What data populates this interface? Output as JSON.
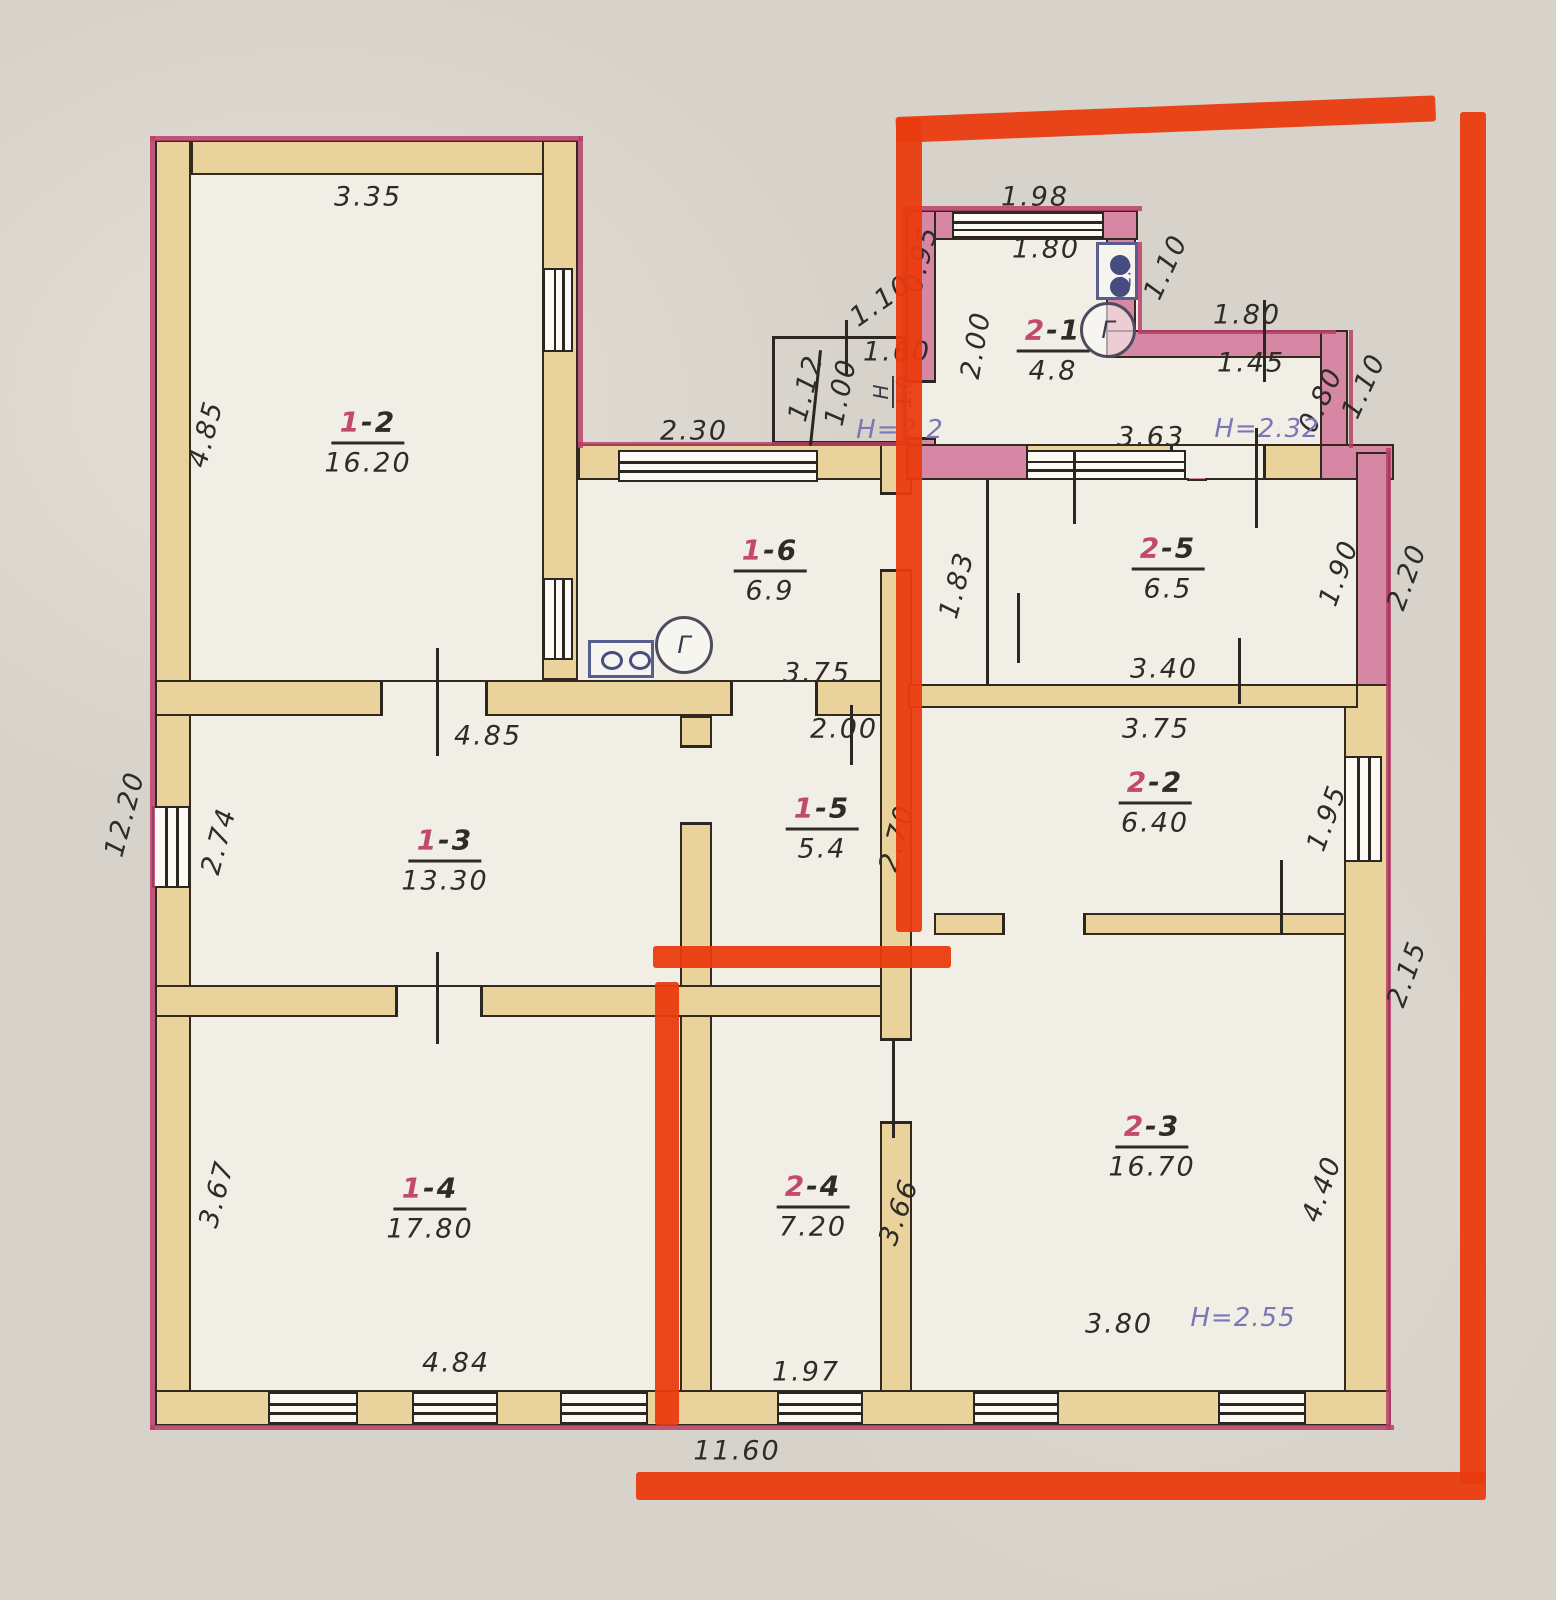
{
  "palette": {
    "paper": "#d7d3cb",
    "room": "#f1eee6",
    "wall_tan": "#e9d29c",
    "wall_pink": "#d687a3",
    "outline": "#33291f",
    "crimson": "#b8406a",
    "marker_orange": "#ea3a0e",
    "ink": "#2f2b26",
    "red_digit": "#c14a6e",
    "height_purple": "#7b76b6",
    "icon_blue": "#585e90"
  },
  "rooms": [
    {
      "prefix": "1",
      "suffix": "-2",
      "area": "16.20",
      "x": 368,
      "y": 442
    },
    {
      "prefix": "1",
      "suffix": "-6",
      "area": "6.9",
      "x": 770,
      "y": 570
    },
    {
      "prefix": "2",
      "suffix": "-1",
      "area": "4.8",
      "x": 1053,
      "y": 350
    },
    {
      "prefix": "2",
      "suffix": "-5",
      "area": "6.5",
      "x": 1168,
      "y": 568
    },
    {
      "prefix": "2",
      "suffix": "-2",
      "area": "6.40",
      "x": 1155,
      "y": 802
    },
    {
      "prefix": "1",
      "suffix": "-5",
      "area": "5.4",
      "x": 822,
      "y": 828
    },
    {
      "prefix": "1",
      "suffix": "-3",
      "area": "13.30",
      "x": 445,
      "y": 860
    },
    {
      "prefix": "2",
      "suffix": "-3",
      "area": "16.70",
      "x": 1152,
      "y": 1146
    },
    {
      "prefix": "1",
      "suffix": "-4",
      "area": "17.80",
      "x": 430,
      "y": 1208
    },
    {
      "prefix": "2",
      "suffix": "-4",
      "area": "7.20",
      "x": 813,
      "y": 1206
    }
  ],
  "dims": [
    [
      "3.35",
      368,
      197,
      0
    ],
    [
      "4.85",
      206,
      434,
      -75
    ],
    [
      "2.30",
      694,
      431,
      0
    ],
    [
      "1.12",
      806,
      388,
      -75
    ],
    [
      "1.00",
      841,
      392,
      -78
    ],
    [
      "1.10",
      881,
      301,
      -35
    ],
    [
      "1.60",
      897,
      352,
      0
    ],
    [
      "1.98",
      1035,
      197,
      0
    ],
    [
      "1.80",
      1046,
      249,
      0
    ],
    [
      "0.95",
      921,
      259,
      -75
    ],
    [
      "2.00",
      976,
      345,
      -80
    ],
    [
      "1.10",
      1166,
      267,
      -65
    ],
    [
      "1.80",
      1247,
      315,
      0
    ],
    [
      "1.45",
      1251,
      363,
      0
    ],
    [
      "0.80",
      1321,
      400,
      -65
    ],
    [
      "1.10",
      1364,
      386,
      -65
    ],
    [
      "3.63",
      1151,
      437,
      0
    ],
    [
      "1.83",
      957,
      585,
      -75
    ],
    [
      "1.90",
      1339,
      573,
      -70
    ],
    [
      "2.20",
      1407,
      577,
      -70
    ],
    [
      "3.40",
      1164,
      669,
      0
    ],
    [
      "3.75",
      1156,
      729,
      0
    ],
    [
      "1.95",
      1327,
      818,
      -70
    ],
    [
      "4.40",
      1322,
      1189,
      -70
    ],
    [
      "2.15",
      1407,
      974,
      -70
    ],
    [
      "3.80",
      1119,
      1324,
      0
    ],
    [
      "3.66",
      899,
      1212,
      -70
    ],
    [
      "1.97",
      806,
      1372,
      0
    ],
    [
      "11.60",
      737,
      1451,
      0
    ],
    [
      "2.00",
      844,
      729,
      0
    ],
    [
      "2.70",
      897,
      838,
      -75
    ],
    [
      "3.75",
      817,
      673,
      0
    ],
    [
      "4.85",
      488,
      736,
      0
    ],
    [
      "2.74",
      219,
      841,
      -75
    ],
    [
      "12.20",
      125,
      814,
      -75
    ],
    [
      "3.67",
      217,
      1194,
      -75
    ],
    [
      "4.84",
      456,
      1363,
      0
    ]
  ],
  "heights": [
    [
      "Н=2.2",
      900,
      430
    ],
    [
      "Н=2.32",
      1267,
      429
    ],
    [
      "Н=2.55",
      1243,
      1318
    ]
  ],
  "fraction": {
    "top": "Н",
    "bottom": "1.0",
    "x": 893,
    "y": 392,
    "rot": -90
  },
  "gas_meters": [
    {
      "label": "Г",
      "x": 1108,
      "y": 330,
      "r": 28
    },
    {
      "label": "Г",
      "x": 684,
      "y": 645,
      "r": 29
    }
  ],
  "stoves": [
    {
      "x": 1096,
      "y": 242,
      "w": 42,
      "h": 58,
      "layout": "stack",
      "text": "2.8"
    },
    {
      "x": 588,
      "y": 640,
      "w": 66,
      "h": 38,
      "layout": "row",
      "text": ""
    }
  ],
  "geometry": {
    "footprints": [
      [
        155,
        141,
        423,
        1284
      ],
      [
        578,
        444,
        812,
        981
      ],
      [
        906,
        212,
        232,
        232
      ],
      [
        1108,
        332,
        240,
        112
      ]
    ],
    "walls": [
      [
        155,
        140,
        36,
        1285
      ],
      [
        191,
        140,
        387,
        35
      ],
      [
        542,
        140,
        36,
        540
      ],
      [
        578,
        444,
        330,
        36
      ],
      [
        906,
        444,
        455,
        36
      ],
      [
        155,
        680,
        753,
        36
      ],
      [
        680,
        716,
        32,
        676
      ],
      [
        155,
        985,
        753,
        32
      ],
      [
        880,
        444,
        32,
        948
      ],
      [
        155,
        1390,
        1236,
        36
      ],
      [
        1344,
        684,
        46,
        708
      ],
      [
        908,
        684,
        450,
        24
      ],
      [
        934,
        913,
        412,
        22
      ]
    ],
    "pink_walls": [
      [
        906,
        210,
        232,
        30
      ],
      [
        906,
        210,
        30,
        236
      ],
      [
        1106,
        238,
        30,
        108
      ],
      [
        1106,
        330,
        222,
        28
      ],
      [
        1320,
        330,
        28,
        116
      ],
      [
        906,
        444,
        122,
        36
      ],
      [
        1320,
        444,
        74,
        36
      ],
      [
        1356,
        452,
        34,
        234
      ],
      [
        1187,
        455,
        20,
        26
      ]
    ],
    "thin_lines": [
      [
        986,
        480,
        3,
        206
      ]
    ],
    "porch": [
      772,
      336,
      134,
      108
    ],
    "windows": [
      [
        543,
        268,
        30,
        84,
        "v"
      ],
      [
        543,
        578,
        30,
        82,
        "v"
      ],
      [
        152,
        806,
        38,
        82,
        "v"
      ],
      [
        1344,
        756,
        38,
        106,
        "v"
      ],
      [
        618,
        450,
        200,
        32,
        "h"
      ],
      [
        952,
        212,
        152,
        26,
        "h"
      ],
      [
        1026,
        450,
        160,
        30,
        "h"
      ],
      [
        268,
        1392,
        90,
        32,
        "h"
      ],
      [
        412,
        1392,
        86,
        32,
        "h"
      ],
      [
        560,
        1392,
        88,
        32,
        "h"
      ],
      [
        777,
        1392,
        86,
        32,
        "h"
      ],
      [
        973,
        1392,
        86,
        32,
        "h"
      ],
      [
        1218,
        1392,
        88,
        32,
        "h"
      ]
    ],
    "door_gaps": [
      [
        380,
        682,
        108,
        34,
        "h"
      ],
      [
        730,
        682,
        88,
        34,
        "h"
      ],
      [
        395,
        987,
        88,
        30,
        "h"
      ],
      [
        1002,
        913,
        84,
        22,
        "h"
      ],
      [
        1170,
        446,
        96,
        32,
        "h"
      ],
      [
        680,
        745,
        32,
        80,
        "v"
      ],
      [
        880,
        492,
        32,
        80,
        "v"
      ],
      [
        906,
        380,
        30,
        60,
        "v"
      ],
      [
        880,
        1038,
        32,
        86,
        "v"
      ]
    ],
    "ticks": [
      [
        436,
        648,
        3,
        108,
        0
      ],
      [
        436,
        952,
        3,
        92,
        0
      ],
      [
        1017,
        593,
        3,
        70,
        0
      ],
      [
        1238,
        638,
        3,
        66,
        0
      ],
      [
        1073,
        452,
        3,
        72,
        0
      ],
      [
        1263,
        300,
        3,
        82,
        0
      ],
      [
        1255,
        428,
        3,
        100,
        0
      ],
      [
        892,
        1038,
        3,
        100,
        0
      ],
      [
        850,
        705,
        3,
        60,
        0
      ],
      [
        845,
        320,
        3,
        55,
        0
      ],
      [
        1280,
        860,
        3,
        75,
        0
      ],
      [
        814,
        350,
        3,
        96,
        6
      ]
    ],
    "crimson_edges": [
      [
        150,
        136,
        433,
        5
      ],
      [
        150,
        136,
        5,
        1294
      ],
      [
        578,
        136,
        5,
        312
      ],
      [
        578,
        442,
        332,
        4
      ],
      [
        902,
        206,
        240,
        5
      ],
      [
        902,
        206,
        5,
        240
      ],
      [
        1138,
        242,
        4,
        92
      ],
      [
        1138,
        330,
        198,
        4
      ],
      [
        1349,
        330,
        4,
        118
      ],
      [
        1386,
        448,
        5,
        982
      ],
      [
        150,
        1425,
        1244,
        5
      ]
    ],
    "marker_lines": [
      [
        896,
        117,
        540,
        26,
        -2.3
      ],
      [
        896,
        118,
        26,
        814,
        0
      ],
      [
        1460,
        112,
        26,
        1372,
        0
      ],
      [
        653,
        946,
        298,
        22,
        0
      ],
      [
        655,
        982,
        24,
        443,
        0
      ],
      [
        636,
        1472,
        850,
        28,
        0
      ]
    ]
  }
}
